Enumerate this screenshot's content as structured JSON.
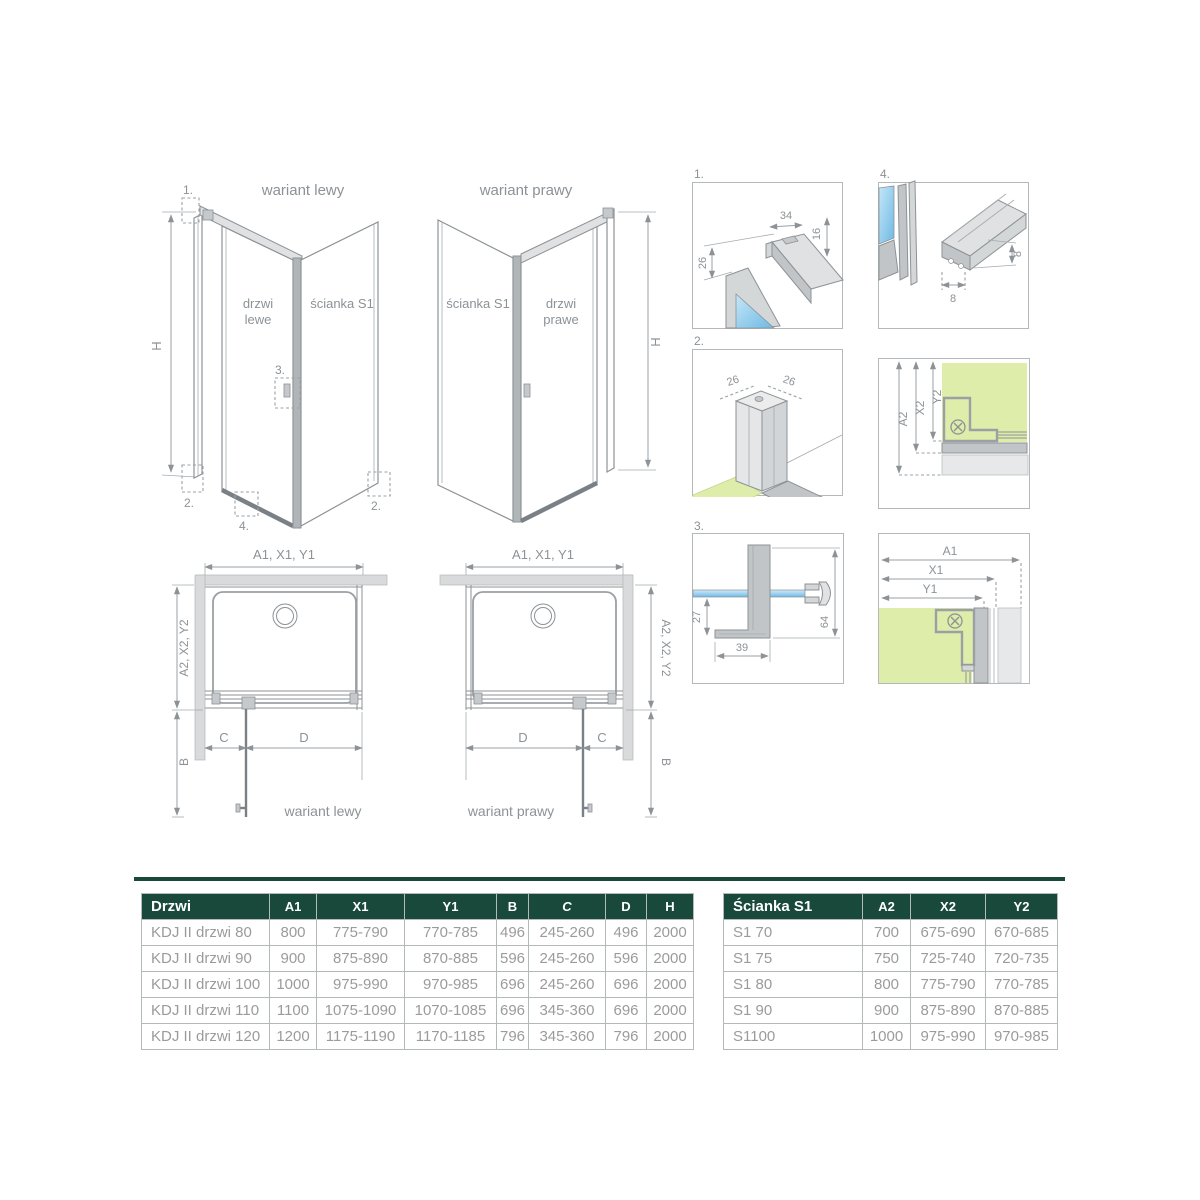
{
  "iso_left": {
    "title": "wariant lewy",
    "door_label_1": "drzwi",
    "door_label_2": "lewe",
    "wall_label": "ścianka S1",
    "height_label": "H",
    "callout_1": "1.",
    "callout_2_left": "2.",
    "callout_2_right": "2.",
    "callout_3": "3.",
    "callout_4": "4."
  },
  "iso_right": {
    "title": "wariant prawy",
    "door_label_1": "drzwi",
    "door_label_2": "prawe",
    "wall_label": "ścianka S1",
    "height_label": "H"
  },
  "details": {
    "d1": {
      "label": "1.",
      "dim_width": "34",
      "dim_height": "16",
      "dim_offset": "26"
    },
    "d2": {
      "label": "2.",
      "dim_left": "26",
      "dim_right": "26"
    },
    "d3": {
      "label": "3.",
      "dim_inset": "27",
      "dim_foot": "39",
      "dim_height": "64"
    },
    "d4": {
      "label": "4.",
      "dim_width": "8",
      "dim_height": "8"
    },
    "section_s1": {
      "dim_a": "A2",
      "dim_x": "X2",
      "dim_y": "Y2"
    },
    "section_door": {
      "dim_a": "A1",
      "dim_x": "X1",
      "dim_y": "Y1"
    }
  },
  "plan_left": {
    "top_dim": "A1, X1, Y1",
    "side_dim": "A2, X2, Y2",
    "b_label": "B",
    "c_label": "C",
    "d_label": "D",
    "caption": "wariant lewy"
  },
  "plan_right": {
    "top_dim": "A1, X1, Y1",
    "side_dim": "A2, X2, Y2",
    "b_label": "B",
    "c_label": "C",
    "d_label": "D",
    "caption": "wariant prawy"
  },
  "tables": {
    "drzwi": {
      "headers": [
        "Drzwi",
        "A1",
        "X1",
        "Y1",
        "B",
        "C",
        "D",
        "H"
      ],
      "rows": [
        [
          "KDJ II drzwi 80",
          "800",
          "775-790",
          "770-785",
          "496",
          "245-260",
          "496",
          "2000"
        ],
        [
          "KDJ II drzwi 90",
          "900",
          "875-890",
          "870-885",
          "596",
          "245-260",
          "596",
          "2000"
        ],
        [
          "KDJ II drzwi 100",
          "1000",
          "975-990",
          "970-985",
          "696",
          "245-260",
          "696",
          "2000"
        ],
        [
          "KDJ II drzwi 110",
          "1100",
          "1075-1090",
          "1070-1085",
          "696",
          "345-360",
          "696",
          "2000"
        ],
        [
          "KDJ II drzwi 120",
          "1200",
          "1175-1190",
          "1170-1185",
          "796",
          "345-360",
          "796",
          "2000"
        ]
      ]
    },
    "scianka": {
      "headers": [
        "Ścianka S1",
        "A2",
        "X2",
        "Y2"
      ],
      "rows": [
        [
          "S1 70",
          "700",
          "675-690",
          "670-685"
        ],
        [
          "S1 75",
          "750",
          "725-740",
          "720-735"
        ],
        [
          "S1 80",
          "800",
          "775-790",
          "770-785"
        ],
        [
          "S1 90",
          "900",
          "875-890",
          "870-885"
        ],
        [
          "S1100",
          "1000",
          "975-990",
          "970-985"
        ]
      ]
    }
  },
  "colors": {
    "table_header_green": "#18493b",
    "wall_green": "#dfedab",
    "glass_blue": "#7cc3e8",
    "line_gray": "#8c9296",
    "value_text_gray": "#9b9b9b"
  }
}
